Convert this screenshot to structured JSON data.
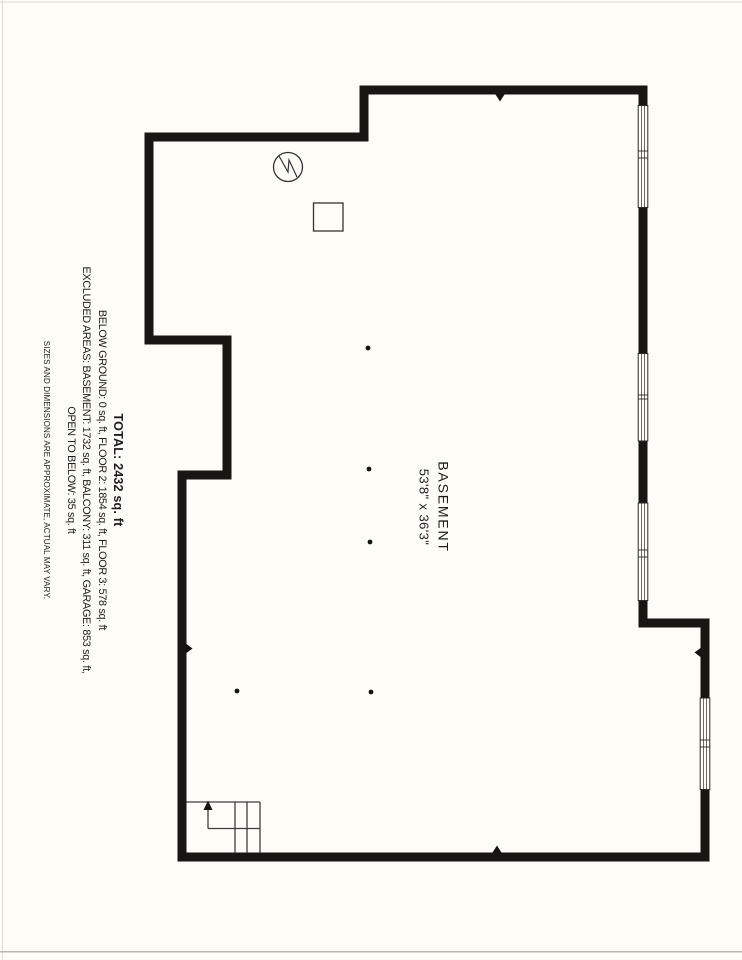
{
  "summary": {
    "total": "TOTAL: 2432 sq. ft",
    "floors": "BELOW GROUND: 0 sq. ft, FLOOR 2: 1854 sq. ft, FLOOR 3: 578 sq. ft",
    "excluded": "EXCLUDED AREAS: BASEMENT: 1732 sq. ft, BALCONY: 311 sq. ft, GARAGE: 853 sq. ft,",
    "excluded2": "OPEN TO BELOW: 35 sq. ft",
    "disclaimer": "SIZES AND DIMENSIONS ARE APPROXIMATE, ACTUAL MAY VARY."
  },
  "room": {
    "name": "BASEMENT",
    "dimensions": "53'8\" x 36'3\""
  },
  "colors": {
    "wall": "#181512",
    "thin_line": "#3c3c3c",
    "paper": "#fdfcf6",
    "paper_edge": "#bdbdb4"
  }
}
